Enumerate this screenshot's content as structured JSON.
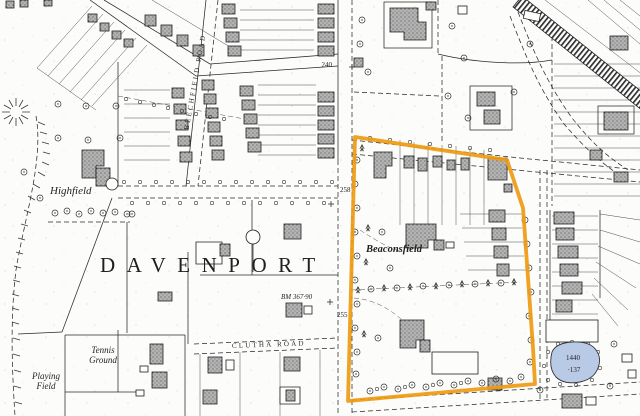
{
  "map": {
    "place_labels": {
      "district": "DAVENPORT",
      "highfield": "Highfield",
      "beaconsfield": "Beaconsfield",
      "tennis_line1": "Tennis",
      "tennis_line2": "Ground",
      "playing_line1": "Playing",
      "playing_line2": "Field"
    },
    "road_labels": {
      "beechfield_road": "BEECHFIELD ROAD",
      "clutha_road": "CLUTHA ROAD"
    },
    "spot_heights": {
      "north": "240",
      "mid": "258",
      "south": "255"
    },
    "benchmark": "BM 367·90",
    "parcel": {
      "number": "1440",
      "area": "·137"
    },
    "colors": {
      "boundary_orange": "#EE9A10",
      "pond_blue": "#B9CAE6",
      "ink": "#1f1f1f",
      "paper": "#FCFCFA",
      "building_grey": "#B3B3B3"
    }
  }
}
